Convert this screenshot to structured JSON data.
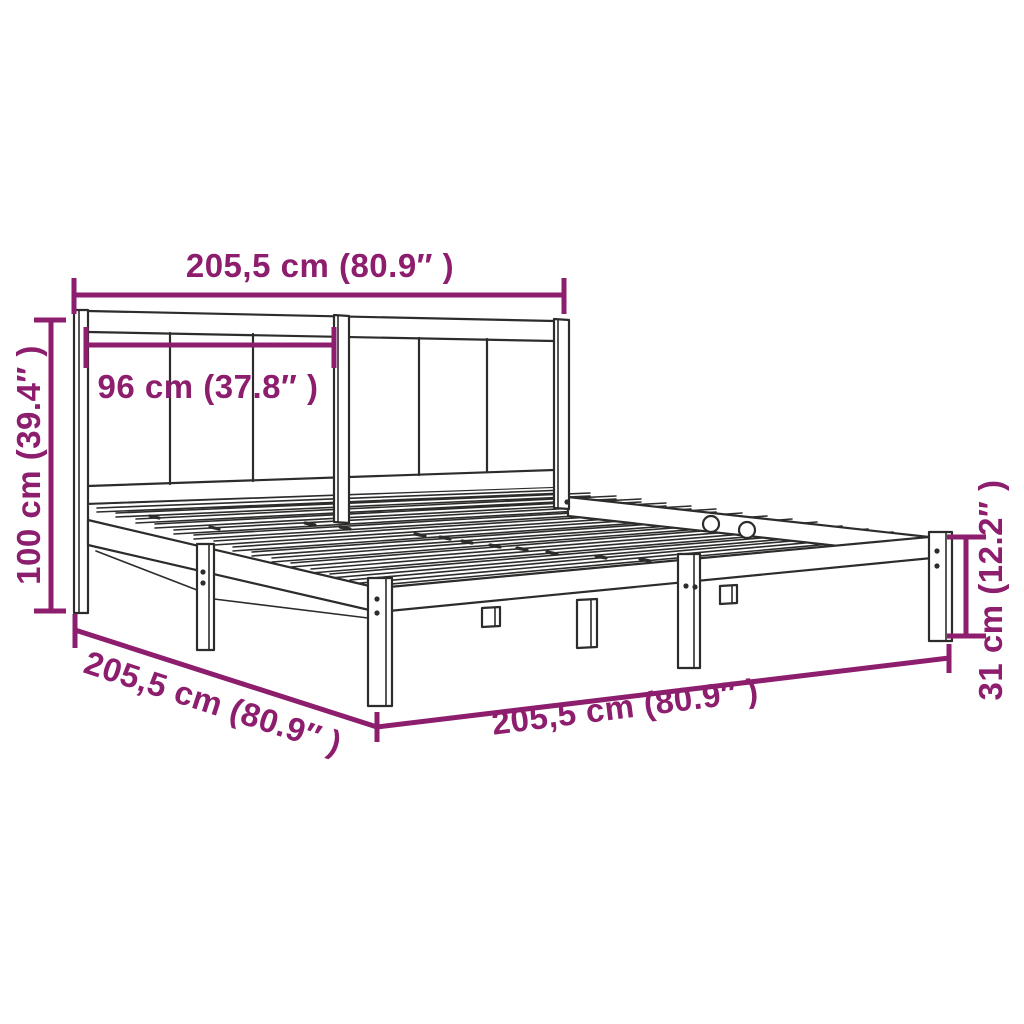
{
  "diagram": {
    "title": "Bed frame with headboard – dimension diagram",
    "subject": "bed-frame",
    "style": "technical line drawing in perspective",
    "colors": {
      "dimension": "#8d1d6d",
      "line": "#2d2c2b",
      "background": "#ffffff"
    },
    "dimensions": {
      "headboard_width": {
        "label": "205,5 cm (80.9″ )",
        "cm": "205,5",
        "inches": "80.9",
        "placement": "top horizontal, full headboard width"
      },
      "panel_width": {
        "label": "96 cm (37.8″ )",
        "cm": "96",
        "inches": "37.8",
        "placement": "horizontal, left headboard panel section"
      },
      "headboard_height": {
        "label": "100 cm (39.4″ )",
        "cm": "100",
        "inches": "39.4",
        "placement": "left vertical, headboard height"
      },
      "frame_length": {
        "label": "205,5 cm (80.9″ )",
        "cm": "205,5",
        "inches": "80.9",
        "placement": "bottom-left diagonal, side length"
      },
      "frame_width": {
        "label": "205,5 cm (80.9″ )",
        "cm": "205,5",
        "inches": "80.9",
        "placement": "bottom horizontal, front width"
      },
      "base_height": {
        "label": "31 cm (12.2″ )",
        "cm": "31",
        "inches": "12.2",
        "placement": "right vertical, frame/leg height"
      }
    }
  }
}
